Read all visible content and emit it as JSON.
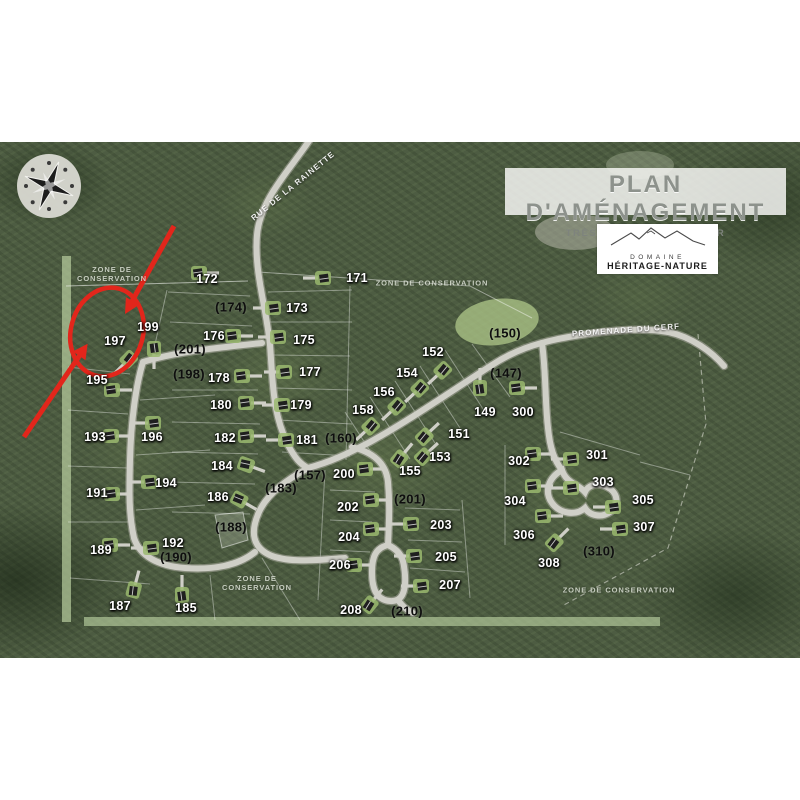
{
  "header": {
    "title": "PLAN D'AMÉNAGEMENT",
    "subtitle": "TRÈS-SAINT-RÉDEMPTEUR"
  },
  "logo": {
    "line1": "DOMAINE",
    "line2": "HÉRITAGE-NATURE"
  },
  "annotation": {
    "color": "#e2261b",
    "highlighted_lot": "197"
  },
  "colors": {
    "road": "#cfcfc7",
    "road_casing": "#a9a99e",
    "conservation_strip": "#b9cf9f",
    "forest": "#4d5c42",
    "house_pad": "#9ab86e",
    "house": "#1f1f1f"
  },
  "road_labels": [
    {
      "text": "RUE DE LA RAINETTE",
      "x": 293,
      "y": 186,
      "rot": -39
    },
    {
      "text": "PROMENADE DU CERF",
      "x": 626,
      "y": 330,
      "rot": -4
    }
  ],
  "zone_labels": [
    {
      "text": "ZONE DE\nCONSERVATION",
      "x": 112,
      "y": 274
    },
    {
      "text": "ZONE DE CONSERVATION",
      "x": 432,
      "y": 283
    },
    {
      "text": "ZONE DE\nCONSERVATION",
      "x": 257,
      "y": 583
    },
    {
      "text": "ZONE DE CONSERVATION",
      "x": 619,
      "y": 590
    }
  ],
  "lots": {
    "numbered": [
      [
        "172",
        207,
        279
      ],
      [
        "171",
        357,
        278
      ],
      [
        "173",
        297,
        308
      ],
      [
        "176",
        214,
        336
      ],
      [
        "175",
        304,
        340
      ],
      [
        "178",
        219,
        378
      ],
      [
        "177",
        310,
        372
      ],
      [
        "180",
        221,
        405
      ],
      [
        "179",
        301,
        405
      ],
      [
        "182",
        225,
        438
      ],
      [
        "181",
        307,
        440
      ],
      [
        "184",
        222,
        466
      ],
      [
        "186",
        218,
        497
      ],
      [
        "197",
        115,
        341
      ],
      [
        "199",
        148,
        327
      ],
      [
        "195",
        97,
        380
      ],
      [
        "193",
        95,
        437
      ],
      [
        "196",
        152,
        437
      ],
      [
        "191",
        97,
        493
      ],
      [
        "194",
        166,
        483
      ],
      [
        "189",
        101,
        550
      ],
      [
        "192",
        173,
        543
      ],
      [
        "187",
        120,
        606
      ],
      [
        "185",
        186,
        608
      ],
      [
        "152",
        433,
        352
      ],
      [
        "154",
        407,
        373
      ],
      [
        "156",
        384,
        392
      ],
      [
        "158",
        363,
        410
      ],
      [
        "151",
        459,
        434
      ],
      [
        "153",
        440,
        457
      ],
      [
        "155",
        410,
        471
      ],
      [
        "149",
        485,
        412
      ],
      [
        "300",
        523,
        412
      ],
      [
        "200",
        344,
        474
      ],
      [
        "202",
        348,
        507
      ],
      [
        "204",
        349,
        537
      ],
      [
        "206",
        340,
        565
      ],
      [
        "208",
        351,
        610
      ],
      [
        "203",
        441,
        525
      ],
      [
        "205",
        446,
        557
      ],
      [
        "207",
        450,
        585
      ],
      [
        "301",
        597,
        455
      ],
      [
        "302",
        519,
        461
      ],
      [
        "303",
        603,
        482
      ],
      [
        "304",
        515,
        501
      ],
      [
        "305",
        643,
        500
      ],
      [
        "306",
        524,
        535
      ],
      [
        "307",
        644,
        527
      ],
      [
        "308",
        549,
        563
      ]
    ],
    "reserved": [
      [
        "(174)",
        231,
        307
      ],
      [
        "(201)",
        190,
        349
      ],
      [
        "(198)",
        189,
        374
      ],
      [
        "(160)",
        341,
        438
      ],
      [
        "(157)",
        310,
        475
      ],
      [
        "(183)",
        281,
        488
      ],
      [
        "(188)",
        231,
        527
      ],
      [
        "(190)",
        176,
        557
      ],
      [
        "(201)",
        410,
        499
      ],
      [
        "(210)",
        407,
        611
      ],
      [
        "(147)",
        506,
        373
      ],
      [
        "(150)",
        505,
        333
      ],
      [
        "(310)",
        599,
        551
      ]
    ]
  },
  "houses": [
    [
      200,
      273,
      0
    ],
    [
      322,
      278,
      180
    ],
    [
      272,
      308,
      180
    ],
    [
      234,
      336,
      0
    ],
    [
      277,
      337,
      180
    ],
    [
      243,
      376,
      0
    ],
    [
      283,
      372,
      180
    ],
    [
      247,
      403,
      0
    ],
    [
      281,
      405,
      180
    ],
    [
      247,
      436,
      0
    ],
    [
      285,
      440,
      180
    ],
    [
      247,
      465,
      20
    ],
    [
      240,
      500,
      30
    ],
    [
      128,
      360,
      135
    ],
    [
      154,
      350,
      90
    ],
    [
      113,
      390,
      0
    ],
    [
      112,
      436,
      0
    ],
    [
      113,
      494,
      0
    ],
    [
      111,
      545,
      0
    ],
    [
      152,
      423,
      180
    ],
    [
      148,
      482,
      180
    ],
    [
      150,
      548,
      180
    ],
    [
      134,
      589,
      -75
    ],
    [
      182,
      594,
      -90
    ],
    [
      442,
      371,
      137
    ],
    [
      419,
      389,
      137
    ],
    [
      396,
      407,
      137
    ],
    [
      370,
      427,
      137
    ],
    [
      425,
      436,
      -43
    ],
    [
      424,
      456,
      -43
    ],
    [
      400,
      458,
      -50
    ],
    [
      480,
      387,
      -90
    ],
    [
      518,
      388,
      0
    ],
    [
      366,
      469,
      0
    ],
    [
      372,
      500,
      0
    ],
    [
      372,
      529,
      0
    ],
    [
      355,
      565,
      0
    ],
    [
      370,
      604,
      -50
    ],
    [
      410,
      524,
      180
    ],
    [
      413,
      556,
      180
    ],
    [
      420,
      586,
      180
    ],
    [
      534,
      454,
      0
    ],
    [
      570,
      459,
      180
    ],
    [
      570,
      488,
      180
    ],
    [
      534,
      486,
      0
    ],
    [
      612,
      507,
      180
    ],
    [
      544,
      516,
      0
    ],
    [
      619,
      529,
      180
    ],
    [
      555,
      542,
      -45
    ]
  ]
}
